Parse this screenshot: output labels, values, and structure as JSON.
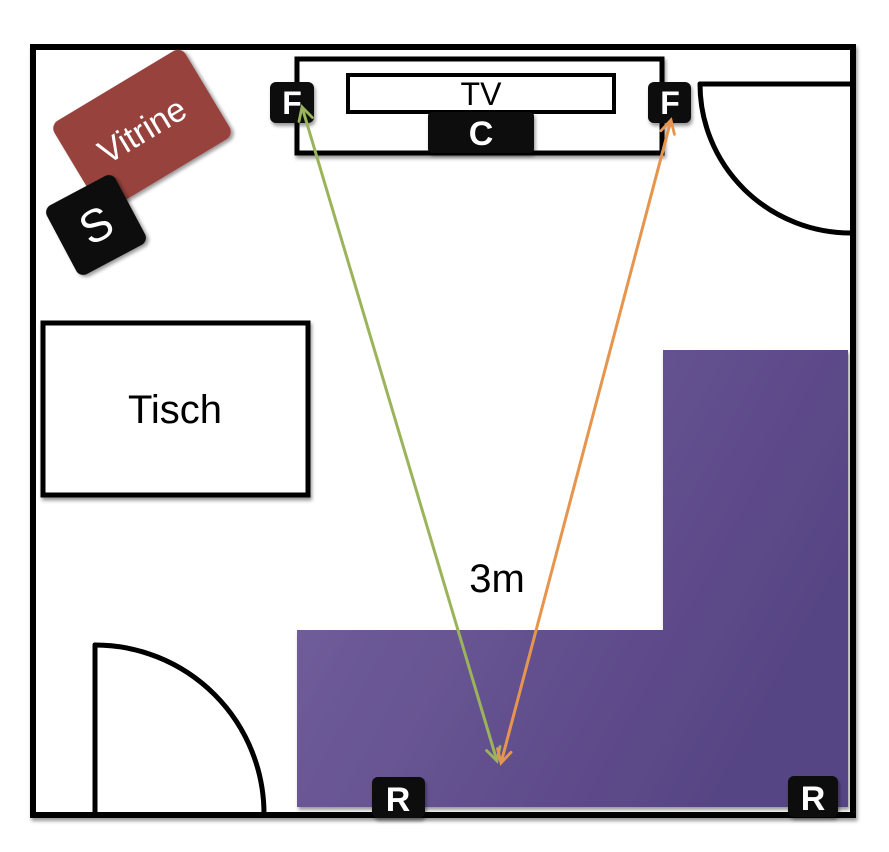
{
  "diagram": {
    "title": "home-theater-room-floorplan",
    "furniture": {
      "vitrine_label": "Vitrine",
      "table_label": "Tisch",
      "tv_label": "TV"
    },
    "speakers": {
      "front_left_label": "F",
      "front_right_label": "F",
      "center_label": "C",
      "subwoofer_label": "S",
      "rear_left_label": "R",
      "rear_right_label": "R"
    },
    "measurement": {
      "distance_label": "3m"
    }
  },
  "colors": {
    "wall_stroke": "#000000",
    "room_fill": "#ffffff",
    "vitrine_fill": "#97423e",
    "speaker_fill": "#0a0a0a",
    "sofa_gradient_light": "#76639f",
    "sofa_gradient_dark": "#574484",
    "arrow_front_left": "#9bb45c",
    "arrow_front_right": "#e6954e",
    "label_light": "#ffffff",
    "label_dark": "#000000"
  }
}
